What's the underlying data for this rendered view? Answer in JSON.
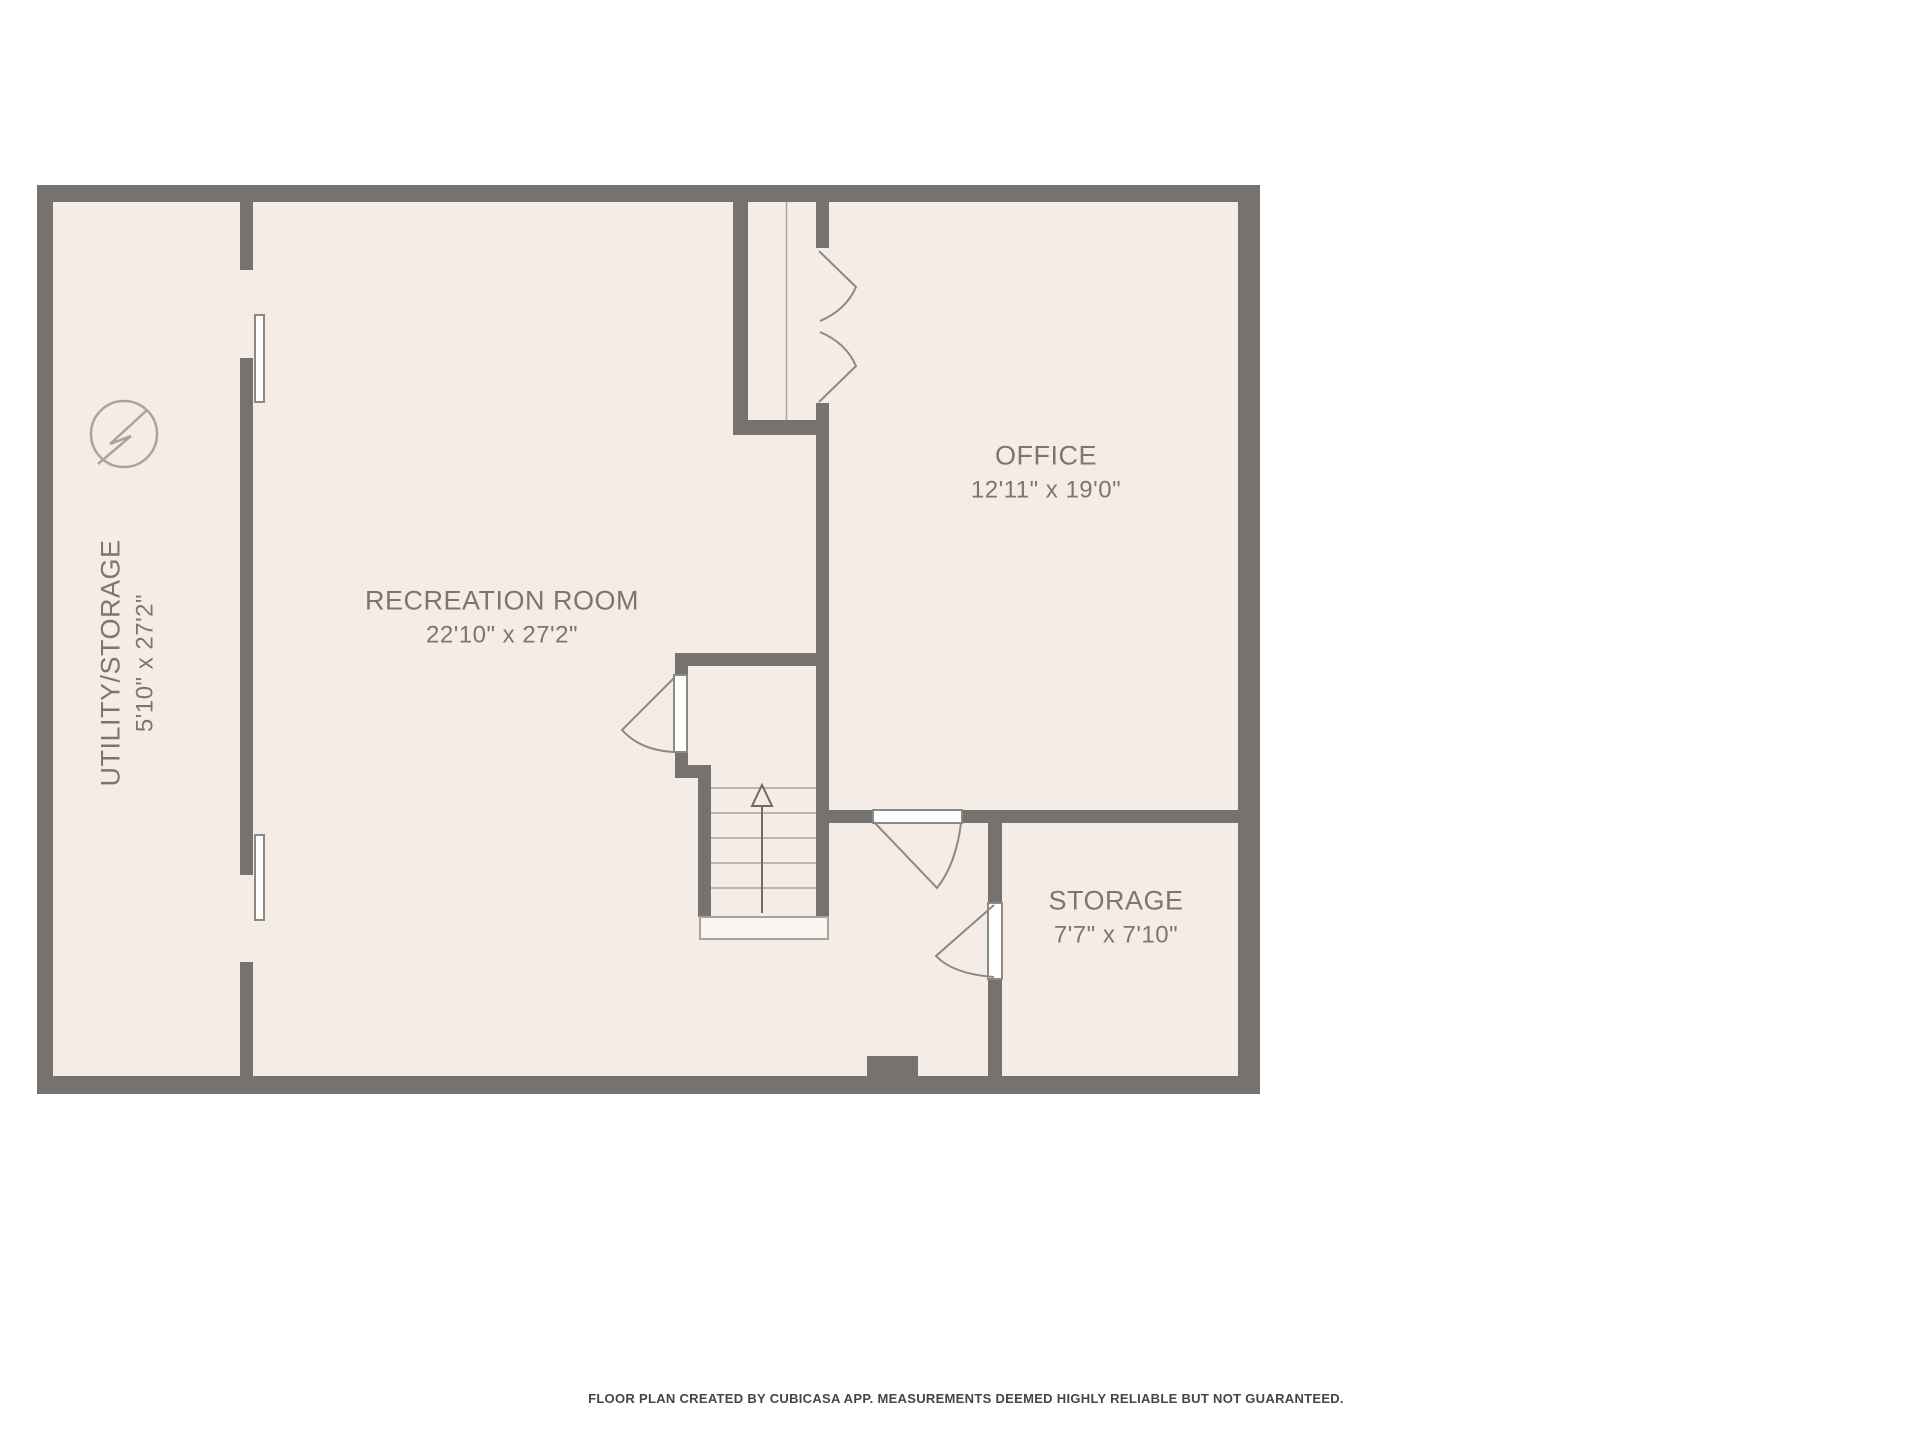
{
  "plan": {
    "title": "Basement floor plan",
    "rooms": [
      {
        "id": "utility-storage",
        "name": "UTILITY/STORAGE",
        "dims": "5'10\" x 27'2\""
      },
      {
        "id": "recreation-room",
        "name": "RECREATION ROOM",
        "dims": "22'10\" x 27'2\""
      },
      {
        "id": "office",
        "name": "OFFICE",
        "dims": "12'11\" x 19'0\""
      },
      {
        "id": "storage",
        "name": "STORAGE",
        "dims": "7'7\" x 7'10\""
      }
    ],
    "icons": [
      {
        "name": "electrical-panel-icon",
        "glyph": "circle-with-lightning-bolt"
      },
      {
        "name": "stairs-up-arrow-icon",
        "glyph": "arrow-up"
      }
    ],
    "colors": {
      "wall": "#75726f",
      "room_fill": "#f5ece6",
      "canvas": "#ffffff",
      "door": "#8c8882",
      "stair_tread": "#bab6b1",
      "label_text": "#7b7671",
      "symbol": "#aaa49d",
      "footer_text": "#454545"
    },
    "footer": "FLOOR PLAN CREATED BY CUBICASA APP. MEASUREMENTS DEEMED HIGHLY RELIABLE BUT NOT GUARANTEED."
  }
}
